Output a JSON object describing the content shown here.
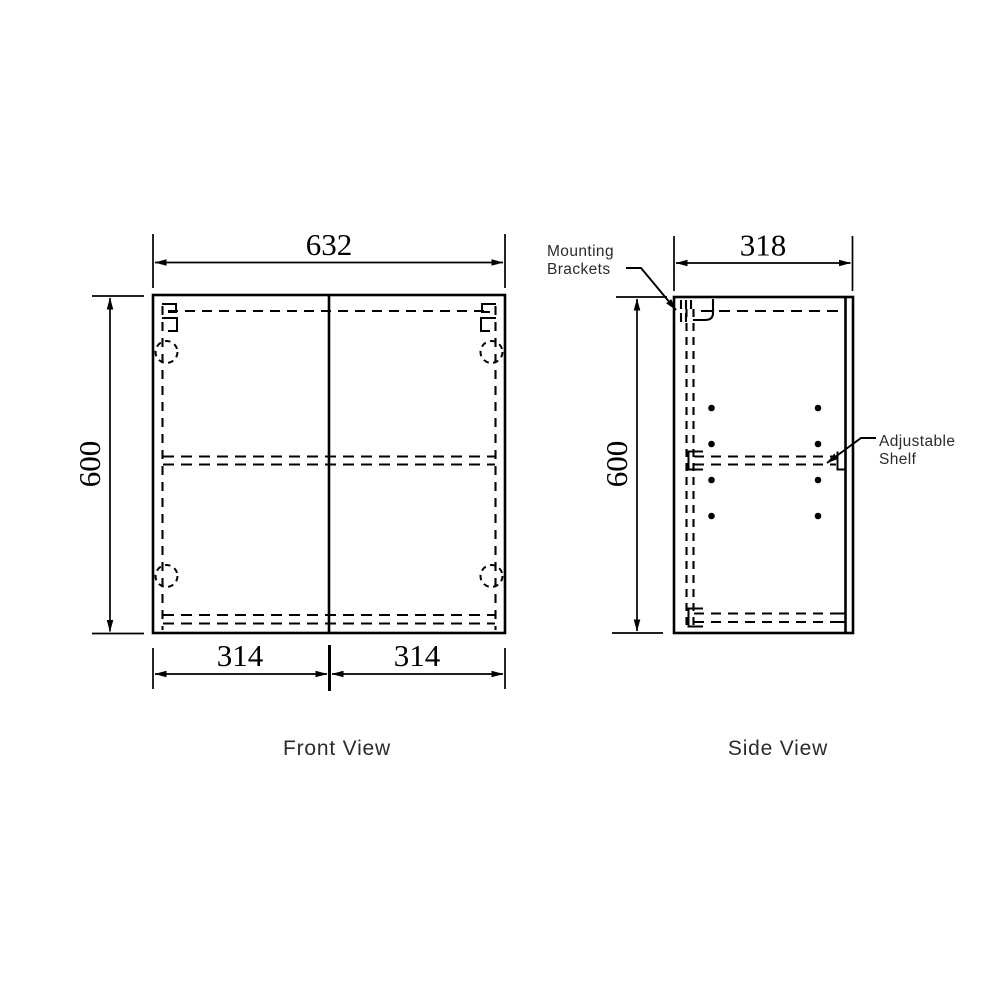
{
  "page": {
    "background": "#ffffff"
  },
  "drawing": {
    "type": "technical-cabinet-drawing",
    "colors": {
      "line": "#000000",
      "label": "#2b2b2b",
      "background": "#ffffff"
    },
    "front_view": {
      "title": "Front View",
      "width_dim": "632",
      "height_dim": "600",
      "left_door_dim": "314",
      "right_door_dim": "314"
    },
    "side_view": {
      "title": "Side View",
      "depth_dim": "318",
      "height_dim": "600",
      "labels": {
        "mounting_brackets": [
          "Mounting",
          "Brackets"
        ],
        "adjustable_shelf": [
          "Adjustable",
          "Shelf"
        ]
      }
    }
  }
}
